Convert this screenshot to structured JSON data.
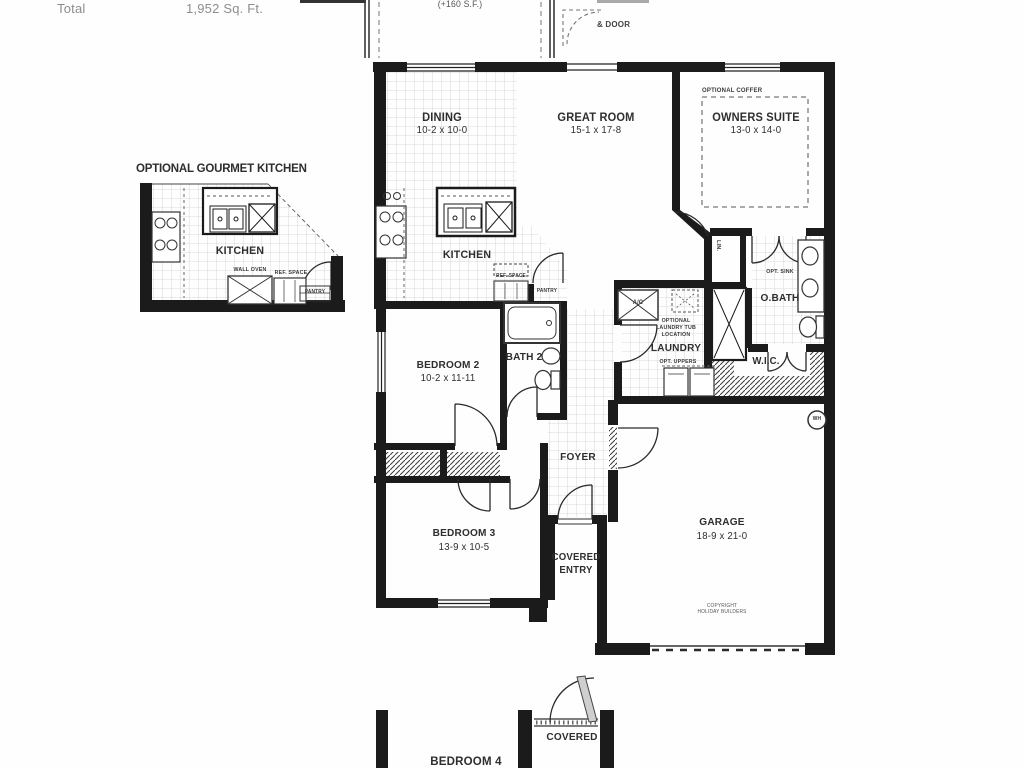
{
  "summary": {
    "total_label": "Total",
    "total_value": "1,952 Sq. Ft."
  },
  "lanai": {
    "area": "(+160 S.F.)",
    "door_note": "& DOOR"
  },
  "inset_kitchen": {
    "title": "OPTIONAL GOURMET KITCHEN",
    "kitchen": "KITCHEN",
    "wall_oven": "WALL OVEN",
    "ref_space": "REF. SPACE",
    "pantry": "PANTRY"
  },
  "rooms": {
    "dining": {
      "name": "DINING",
      "dims": "10-2 x 10-0"
    },
    "great_room": {
      "name": "GREAT ROOM",
      "dims": "15-1 x 17-8"
    },
    "owners_suite": {
      "name": "OWNERS SUITE",
      "dims": "13-0 x 14-0",
      "coffer": "OPTIONAL COFFER"
    },
    "kitchen": {
      "name": "KITCHEN",
      "ref_space": "REF. SPACE",
      "pantry": "PANTRY"
    },
    "bath2": {
      "name": "BATH 2"
    },
    "bedroom2": {
      "name": "BEDROOM 2",
      "dims": "10-2 x 11-11"
    },
    "laundry": {
      "name": "LAUNDRY",
      "opt_tub_l1": "OPTIONAL",
      "opt_tub_l2": "LAUNDRY TUB",
      "opt_tub_l3": "LOCATION",
      "opt_uppers": "OPT. UPPERS",
      "ac": "A/C"
    },
    "owners_bath": {
      "name": "O.BATH",
      "opt_sink": "OPT. SINK",
      "linen": "LIN."
    },
    "wic": {
      "name": "W.I.C."
    },
    "foyer": {
      "name": "FOYER"
    },
    "bedroom3": {
      "name": "BEDROOM 3",
      "dims": "13-9 x 10-5"
    },
    "covered_entry": {
      "line1": "COVERED",
      "line2": "ENTRY"
    },
    "garage": {
      "name": "GARAGE",
      "dims": "18-9 x 21-0",
      "water_heater": "WH",
      "copyright_l1": "COPYRIGHT",
      "copyright_l2": "HOLIDAY BUILDERS"
    },
    "bedroom4": {
      "name": "BEDROOM 4"
    },
    "covered_entry_lower": {
      "name": "COVERED"
    }
  }
}
